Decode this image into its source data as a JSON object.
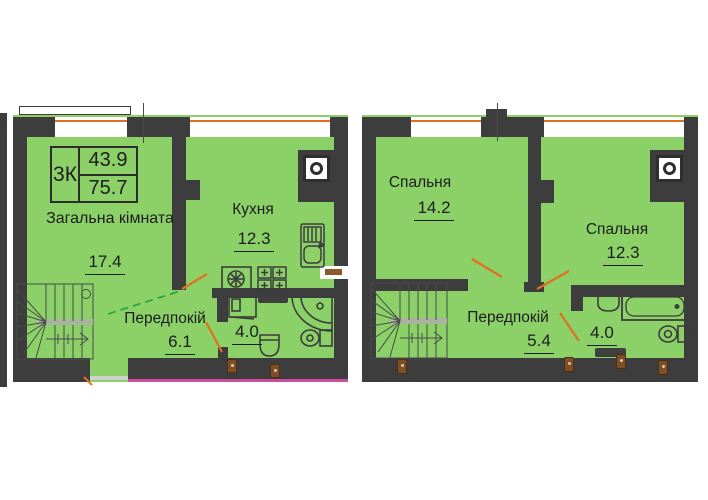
{
  "colors": {
    "room_fill": "#8bd168",
    "wall": "#3d3d3d",
    "window_line": "#e0701f",
    "door_line": "#e0701f",
    "stair_cut_line": "#2fa43c",
    "porch_line": "#c9519c",
    "fixture_outline": "#3c3c3c",
    "socket": "#7d4f26",
    "text": "#1c1c1c",
    "background": "#ffffff"
  },
  "left_plan": {
    "info_box": {
      "unit_type": "3К",
      "living_area": "43.9",
      "total_area": "75.7"
    },
    "rooms": {
      "living": {
        "name": "Загальна кімната",
        "area": "17.4"
      },
      "kitchen": {
        "name": "Кухня",
        "area": "12.3"
      },
      "hallway": {
        "name": "Передпокій",
        "area": "6.1"
      },
      "bathroom": {
        "area": "4.0"
      }
    }
  },
  "right_plan": {
    "rooms": {
      "bedroom_1": {
        "name": "Спальня",
        "area": "14.2"
      },
      "bedroom_2": {
        "name": "Спальня",
        "area": "12.3"
      },
      "hallway": {
        "name": "Передпокій",
        "area": "5.4"
      },
      "bathroom": {
        "area": "4.0"
      }
    }
  }
}
